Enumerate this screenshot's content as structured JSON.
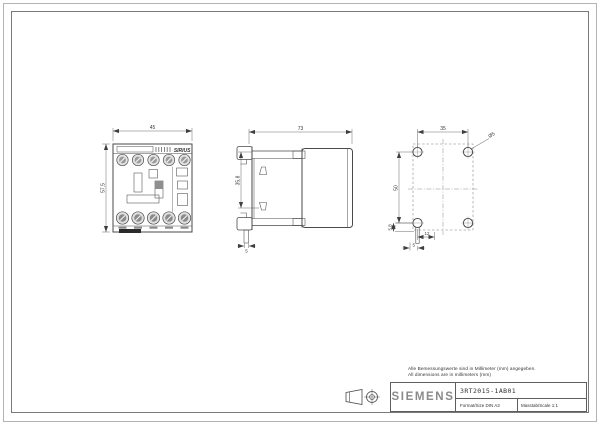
{
  "sheet": {
    "background": "#ffffff",
    "border_color": "#7a7a7a",
    "line_color": "#4a4a4a"
  },
  "notes": {
    "line1": "Alle Bemessungswerte sind in Millimeter (mm) angegeben.",
    "line2": "All dimensions are in millimeters (mm)"
  },
  "title_block": {
    "brand": "SIEMENS",
    "part_number": "3RT2015-1AB01",
    "format": "Format/Size DIN A3",
    "scale": "Masstab/Scale 1:1"
  },
  "views": {
    "front": {
      "label": "SIRIUS",
      "width": "45",
      "height": "57,5"
    },
    "side": {
      "depth": "73",
      "clip_span": "35,8",
      "foot": "5"
    },
    "drill": {
      "spacing_x": "35",
      "spacing_y": "50",
      "hole_diameter": "Ø5",
      "offset_a": "12",
      "offset_b": "5",
      "offset_c": "5,8"
    }
  }
}
